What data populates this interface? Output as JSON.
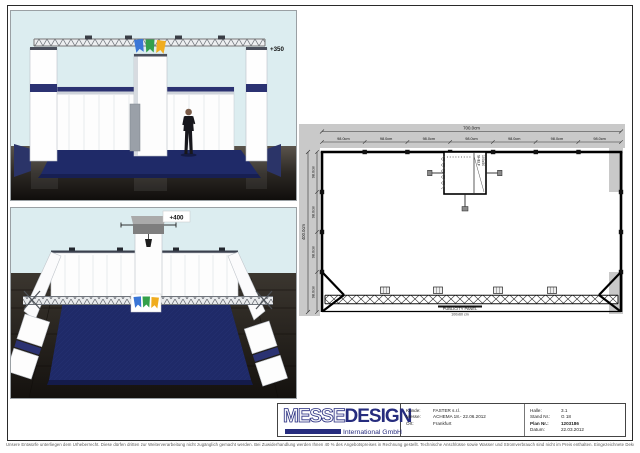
{
  "colors": {
    "flag_blue": "#3a76d6",
    "flag_green": "#33a04a",
    "flag_yellow": "#f0ad1f",
    "carpet_navy": "#1f2a68",
    "logo_navy": "#262c7e",
    "sky": "#dcedf0"
  },
  "front_view": {
    "height_label": "+350"
  },
  "rear_view": {
    "height_label": "+400"
  },
  "floor_plan": {
    "width_total": "700.0cm",
    "depth_total": "400.0cm",
    "width_segments": [
      "98.0cm",
      "98.0cm",
      "98.0cm",
      "98.0cm",
      "98.0cm",
      "98.0cm",
      "98.0cm"
    ],
    "depth_segments": [
      "98.0cm",
      "98.0cm",
      "98.0cm",
      "98.0cm"
    ],
    "storage_text_1": "SHELF",
    "storage_text_2": "100x50",
    "publicity_panel_label": "PUBLICITY PANEL",
    "publicity_panel_size": "100x60 cm"
  },
  "title_block": {
    "logo_messe": "MESSE",
    "logo_design": "DESIGN",
    "logo_subtitle": "International GmbH",
    "fields": {
      "kunde_label": "Kunde:",
      "kunde_value": "FASTER s.r.l.",
      "messe_label": "Messe:",
      "messe_value": "ACHEMA 18.- 22.06.2012",
      "ort_label": "Ort:",
      "ort_value": "Frankfurt",
      "halle_label": "Halle:",
      "halle_value": "3.1",
      "stand_label": "Stand Nr.:",
      "stand_value": "G 18",
      "plan_label": "Plan Nr.:",
      "plan_value": "1203186",
      "datum_label": "Datum:",
      "datum_value": "22.03.2012"
    }
  },
  "footer": {
    "disclaimer": "Unsere Entwürfe unterliegen dem Urheberrecht. Diese dürfen dritten zur Weiterverarbeitung nicht zugänglich gemacht werden. Bei Zuwiderhandlung werden Ihnen 40 % des Angebotspreises in Rechnung gestellt. Technische Anschlüsse sowie Wasser und Stromverbrauch sind nicht im Preis enthalten. Eingezeichnete Dekorationen und Gegenstände die nicht in der Leistungsbeschreibung enthalten sind, gehören nicht zum Lieferumfang. Änderungen durch die Messe bleiben vorbehalten."
  }
}
